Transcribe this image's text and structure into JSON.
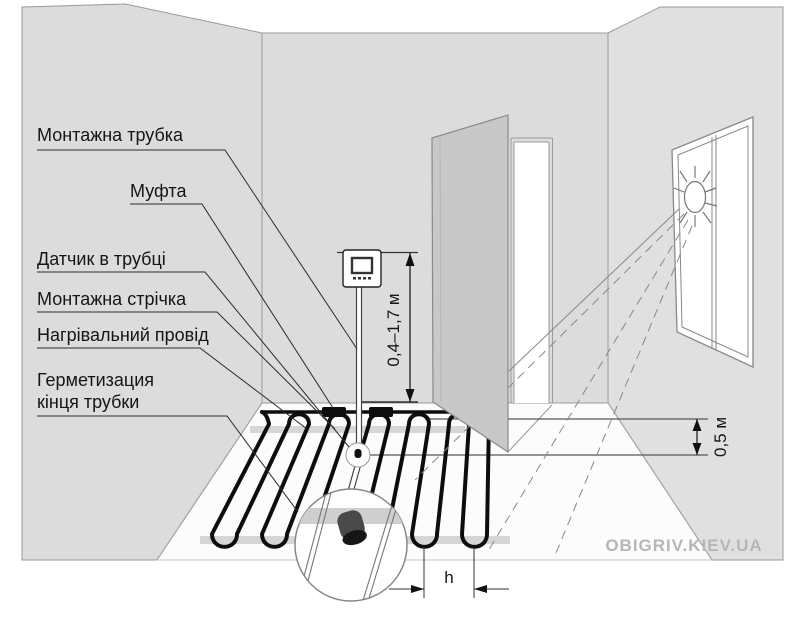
{
  "diagram": {
    "description": "Floor heating installation scheme in a room with thermostat, sensor tube, heating cable, open door and sunlit window",
    "labels": [
      {
        "text": "Монтажна трубка"
      },
      {
        "text": "Муфта"
      },
      {
        "text": "Датчик в трубці"
      },
      {
        "text": "Монтажна стрічка"
      },
      {
        "text": "Нагрівальний провід"
      },
      {
        "line1": "Герметизация",
        "line2": "кінця трубки"
      }
    ],
    "dimensions": {
      "thermostat_height": "0,4–1,7 м",
      "wall_indent": "0,5 м",
      "cable_spacing": "h"
    },
    "watermark": "OBIGRIV.KIEV.UA",
    "icons": [
      "sun-icon",
      "thermostat-icon",
      "magnifier-detail-circle"
    ],
    "colors": {
      "wall": "#dcdcdc",
      "right_wall": "#e0e0e0",
      "door": "#c8c8c8",
      "tape": "#d6d6d6",
      "cable": "#0d0d0d",
      "sensor_body": "#494949",
      "watermark": "#b6b6b6",
      "line": "#9a9a9a"
    }
  }
}
